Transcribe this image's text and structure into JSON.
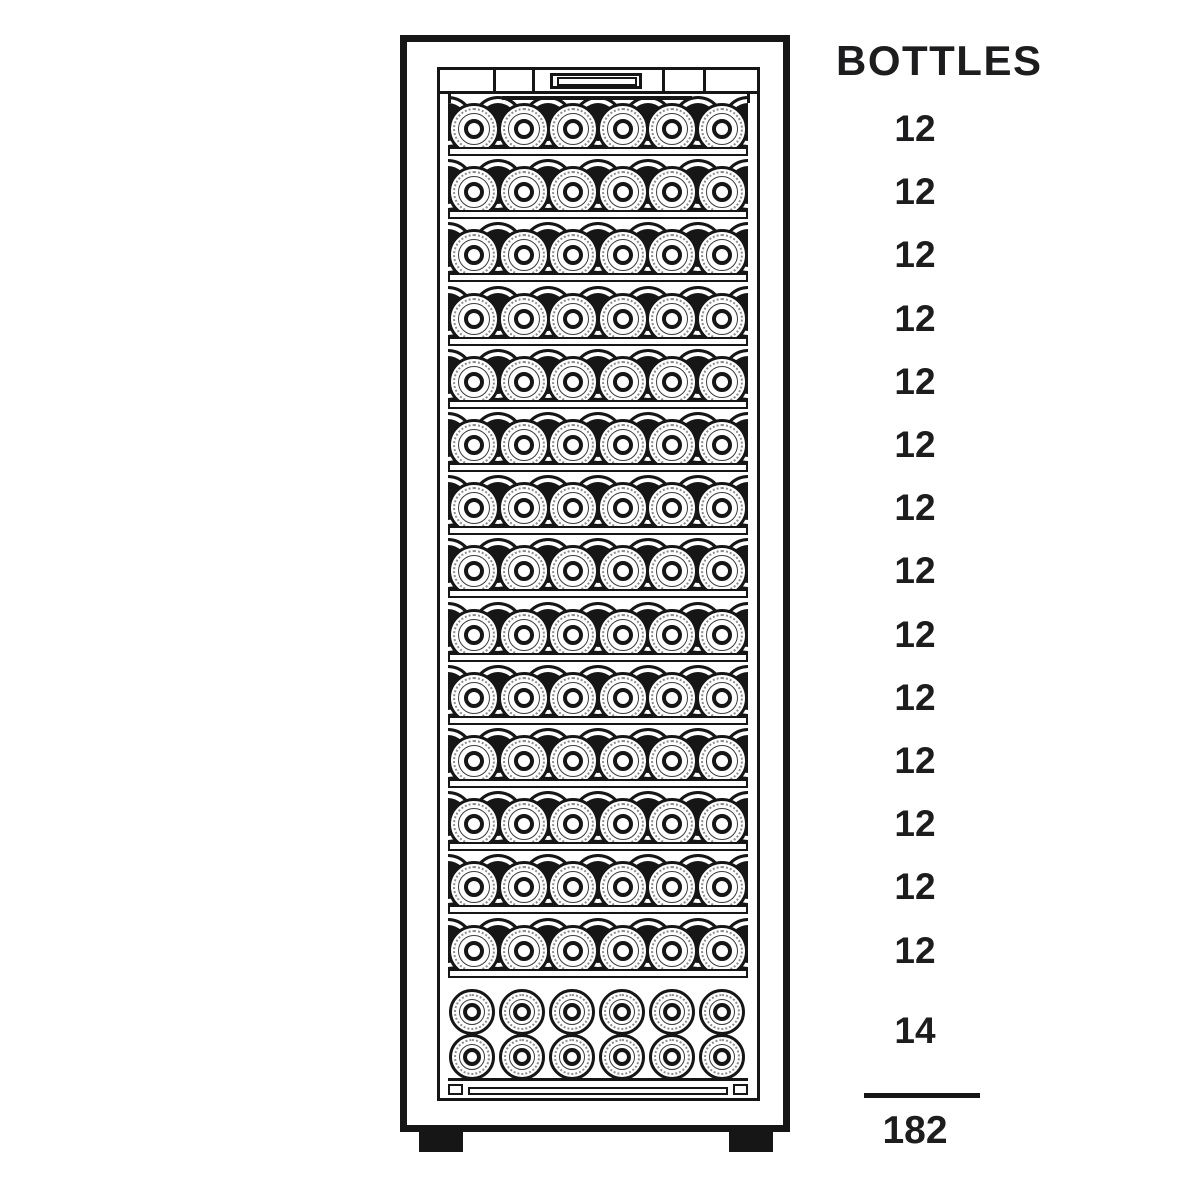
{
  "rack": {
    "title": "BOTTLES",
    "shelves": [
      {
        "label": "12",
        "bottles": 12
      },
      {
        "label": "12",
        "bottles": 12
      },
      {
        "label": "12",
        "bottles": 12
      },
      {
        "label": "12",
        "bottles": 12
      },
      {
        "label": "12",
        "bottles": 12
      },
      {
        "label": "12",
        "bottles": 12
      },
      {
        "label": "12",
        "bottles": 12
      },
      {
        "label": "12",
        "bottles": 12
      },
      {
        "label": "12",
        "bottles": 12
      },
      {
        "label": "12",
        "bottles": 12
      },
      {
        "label": "12",
        "bottles": 12
      },
      {
        "label": "12",
        "bottles": 12
      },
      {
        "label": "12",
        "bottles": 12
      },
      {
        "label": "12",
        "bottles": 12
      }
    ],
    "bottom_compartment": {
      "label": "14",
      "bottles": 14
    },
    "total_label": "182",
    "total": 182,
    "front_bottles_per_shelf": 6,
    "bottom_rows": 2,
    "colors": {
      "line": "#161616",
      "text": "#1d1d1f",
      "background": "#ffffff"
    }
  }
}
